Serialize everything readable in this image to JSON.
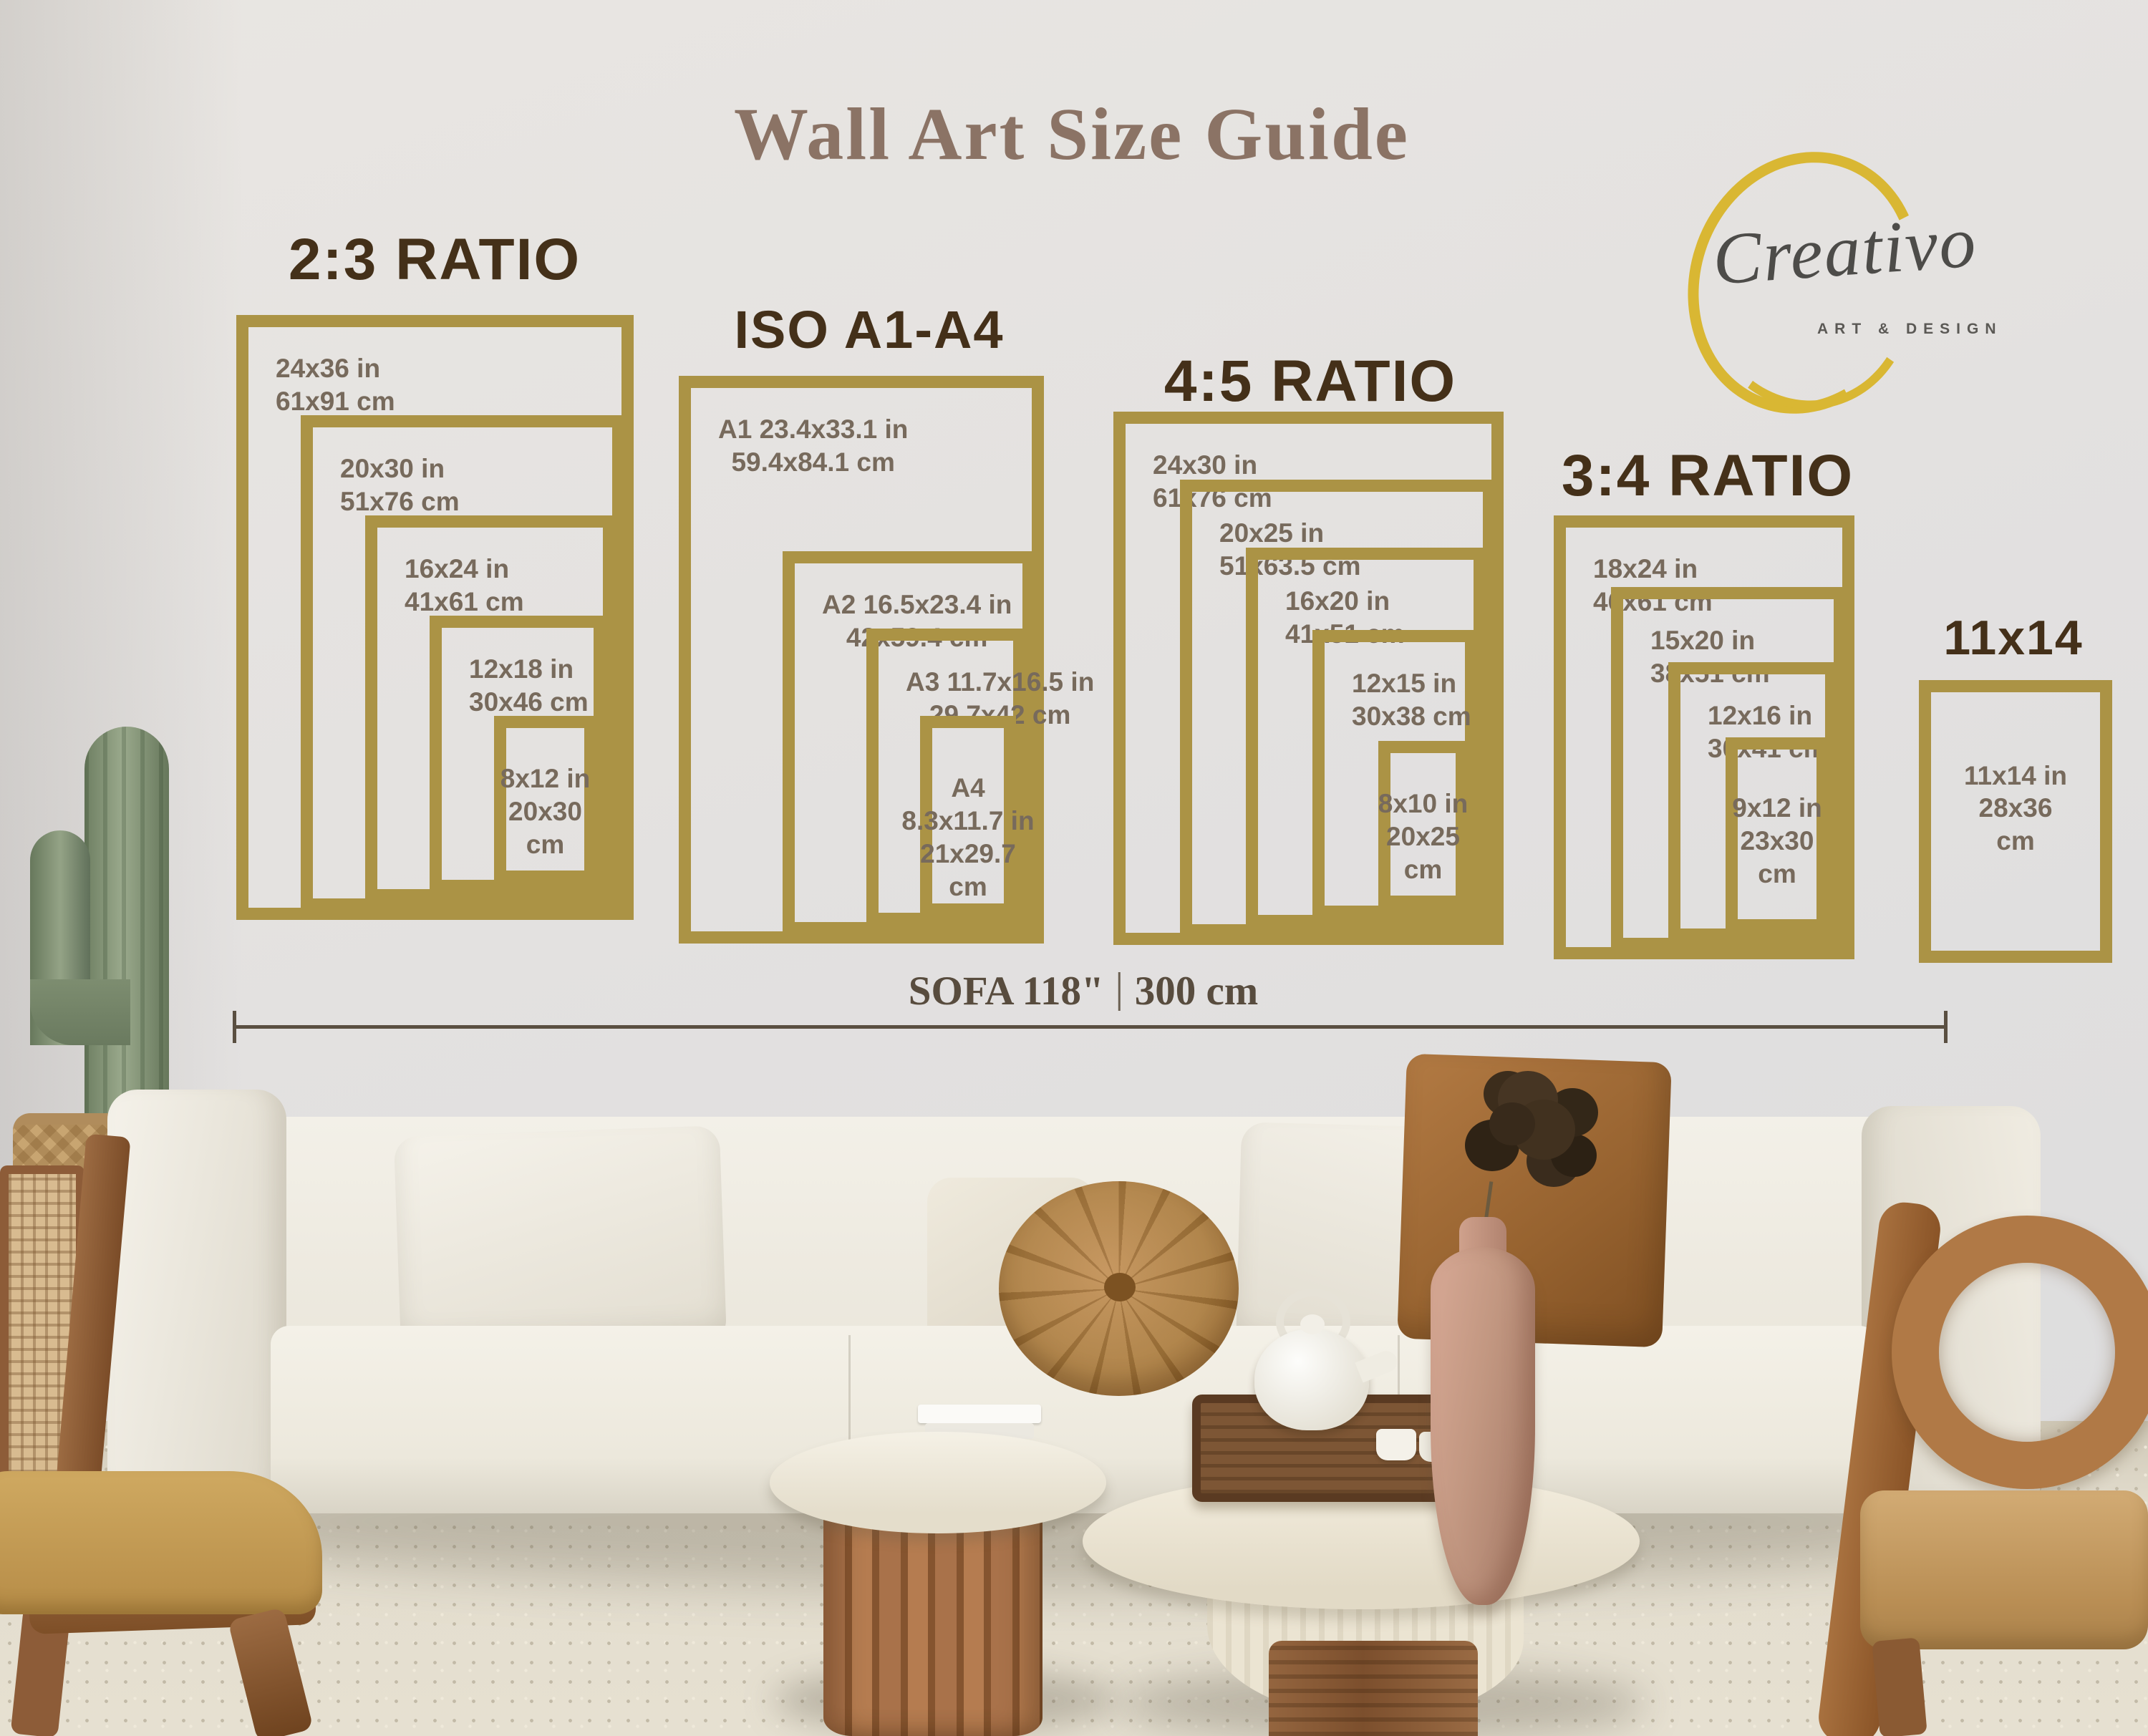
{
  "title": "Wall Art Size Guide",
  "logo": {
    "brand": "Creativo",
    "tagline": "ART & DESIGN"
  },
  "sofa_measure": {
    "inches": "SOFA 118\"",
    "cm": "300 cm"
  },
  "colors": {
    "frame_gold": "#ab9345",
    "heading_brown": "#443019",
    "label_gray": "#776a5c",
    "title_brown": "#8b7365",
    "logo_yellow": "#d9b733"
  },
  "groups": [
    {
      "id": "ratio-2-3",
      "heading": "2:3 RATIO",
      "frames": [
        {
          "slug": "24x36",
          "lines": [
            "24x36 in",
            "61x91 cm"
          ]
        },
        {
          "slug": "20x30",
          "lines": [
            "20x30 in",
            "51x76 cm"
          ]
        },
        {
          "slug": "16x24",
          "lines": [
            "16x24 in",
            "41x61 cm"
          ]
        },
        {
          "slug": "12x18",
          "lines": [
            "12x18 in",
            "30x46 cm"
          ]
        },
        {
          "slug": "8x12",
          "lines": [
            "8x12 in",
            "20x30",
            "cm"
          ]
        }
      ]
    },
    {
      "id": "iso-a1-a4",
      "heading": "ISO A1-A4",
      "frames": [
        {
          "slug": "a1",
          "lines": [
            "A1 23.4x33.1 in",
            "59.4x84.1 cm"
          ]
        },
        {
          "slug": "a2",
          "lines": [
            "A2 16.5x23.4 in",
            "42x59.4 cm"
          ]
        },
        {
          "slug": "a3",
          "lines": [
            "A3 11.7x16.5 in",
            "29.7x42 cm"
          ]
        },
        {
          "slug": "a4",
          "lines": [
            "A4",
            "8.3x11.7 in",
            "21x29.7",
            "cm"
          ]
        }
      ]
    },
    {
      "id": "ratio-4-5",
      "heading": "4:5 RATIO",
      "frames": [
        {
          "slug": "24x30",
          "lines": [
            "24x30 in",
            "61x76 cm"
          ]
        },
        {
          "slug": "20x25",
          "lines": [
            "20x25 in",
            "51x63.5 cm"
          ]
        },
        {
          "slug": "16x20",
          "lines": [
            "16x20 in",
            "41x51 cm"
          ]
        },
        {
          "slug": "12x15",
          "lines": [
            "12x15 in",
            "30x38 cm"
          ]
        },
        {
          "slug": "8x10",
          "lines": [
            "8x10 in",
            "20x25",
            "cm"
          ]
        }
      ]
    },
    {
      "id": "ratio-3-4",
      "heading": "3:4 RATIO",
      "frames": [
        {
          "slug": "18x24",
          "lines": [
            "18x24 in",
            "46x61 cm"
          ]
        },
        {
          "slug": "15x20",
          "lines": [
            "15x20 in",
            "38x51 cm"
          ]
        },
        {
          "slug": "12x16",
          "lines": [
            "12x16 in",
            "30x41 cm"
          ]
        },
        {
          "slug": "9x12",
          "lines": [
            "9x12 in",
            "23x30",
            "cm"
          ]
        }
      ]
    },
    {
      "id": "size-11x14",
      "heading": "11x14",
      "frames": [
        {
          "slug": "11x14",
          "lines": [
            "11x14 in",
            "28x36",
            "cm"
          ]
        }
      ]
    }
  ]
}
